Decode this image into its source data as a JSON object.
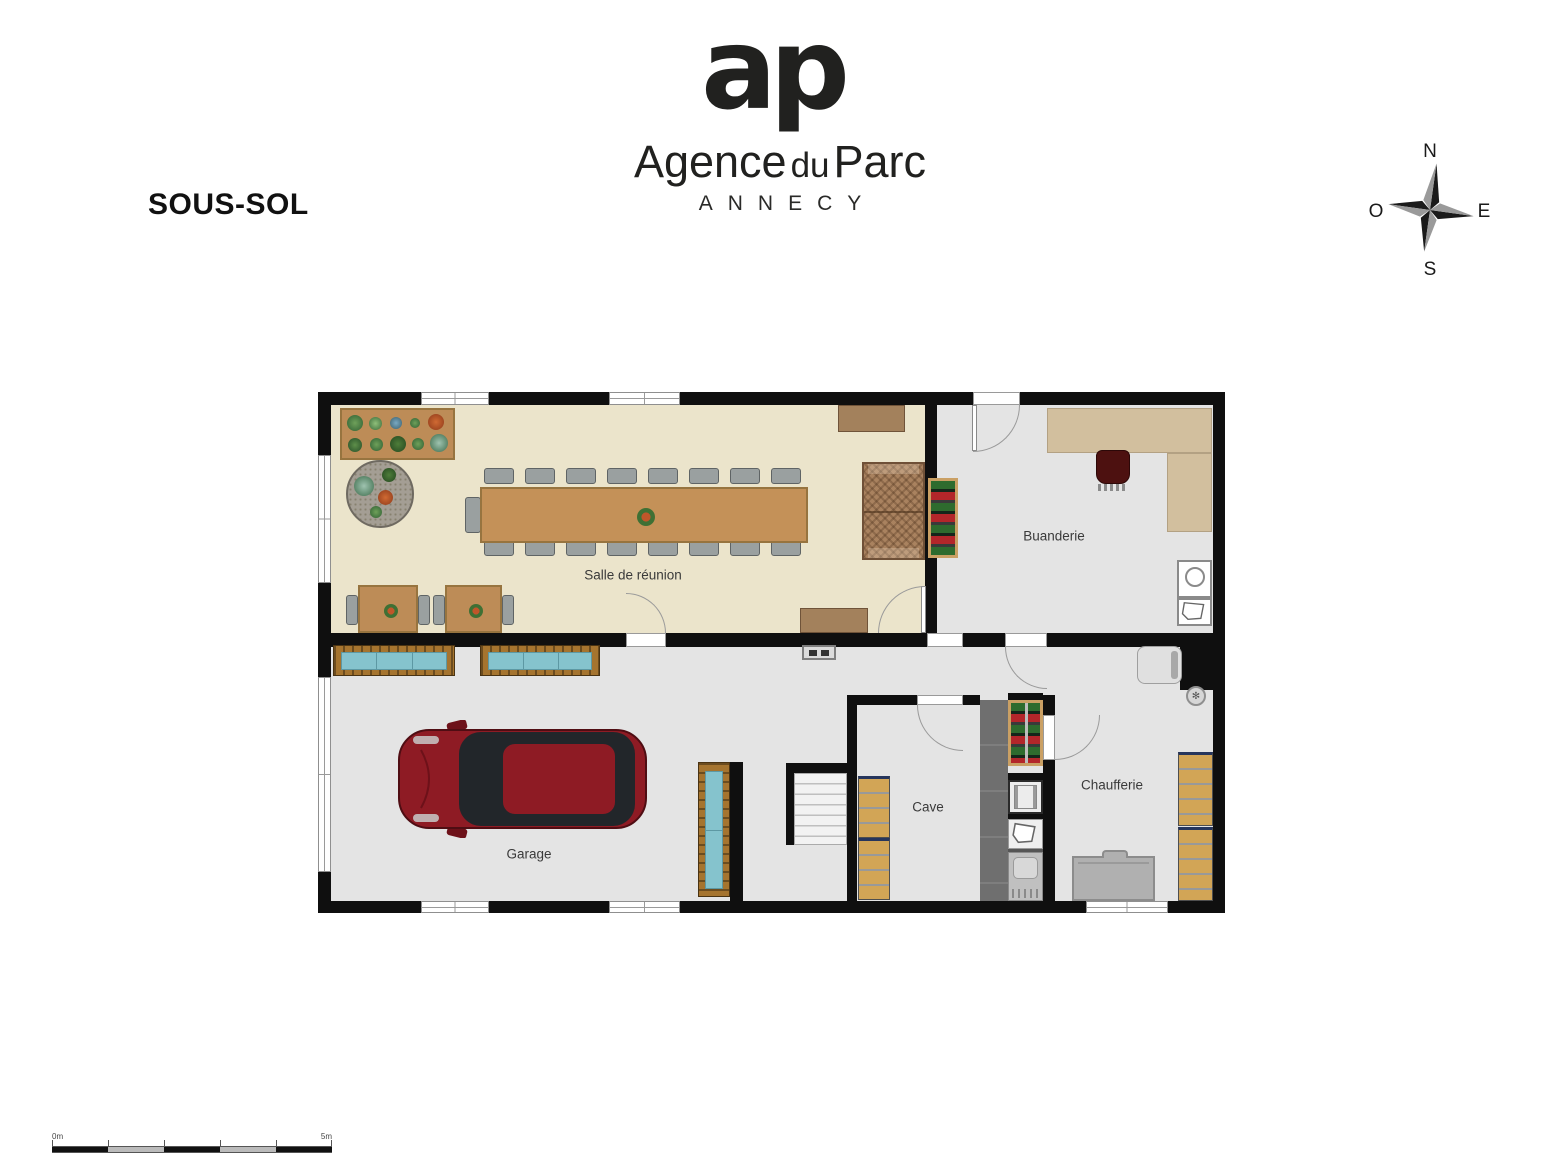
{
  "title": "SOUS-SOL",
  "logo": {
    "monogram": "ap",
    "brand_first": "Agence",
    "brand_mid": "du",
    "brand_last": "Parc",
    "city": "ANNECY"
  },
  "compass": {
    "north": "N",
    "east": "E",
    "south": "S",
    "west": "O"
  },
  "rooms": {
    "meeting_room": "Salle de réunion",
    "laundry": "Buanderie",
    "garage": "Garage",
    "cellar": "Cave",
    "boiler_room": "Chaufferie"
  },
  "scale_bar": {
    "start_label": "0m",
    "end_label": "5m"
  },
  "icons": {
    "valve": "✻"
  },
  "colors": {
    "wall": "#0f0f0f",
    "meeting_floor": "#ebe4cb",
    "grey_floor": "#e4e4e4",
    "wood": "#c49158",
    "bench_teal": "#85c3cd",
    "car_red": "#8e1b24",
    "shelf_tan": "#d2a556"
  }
}
